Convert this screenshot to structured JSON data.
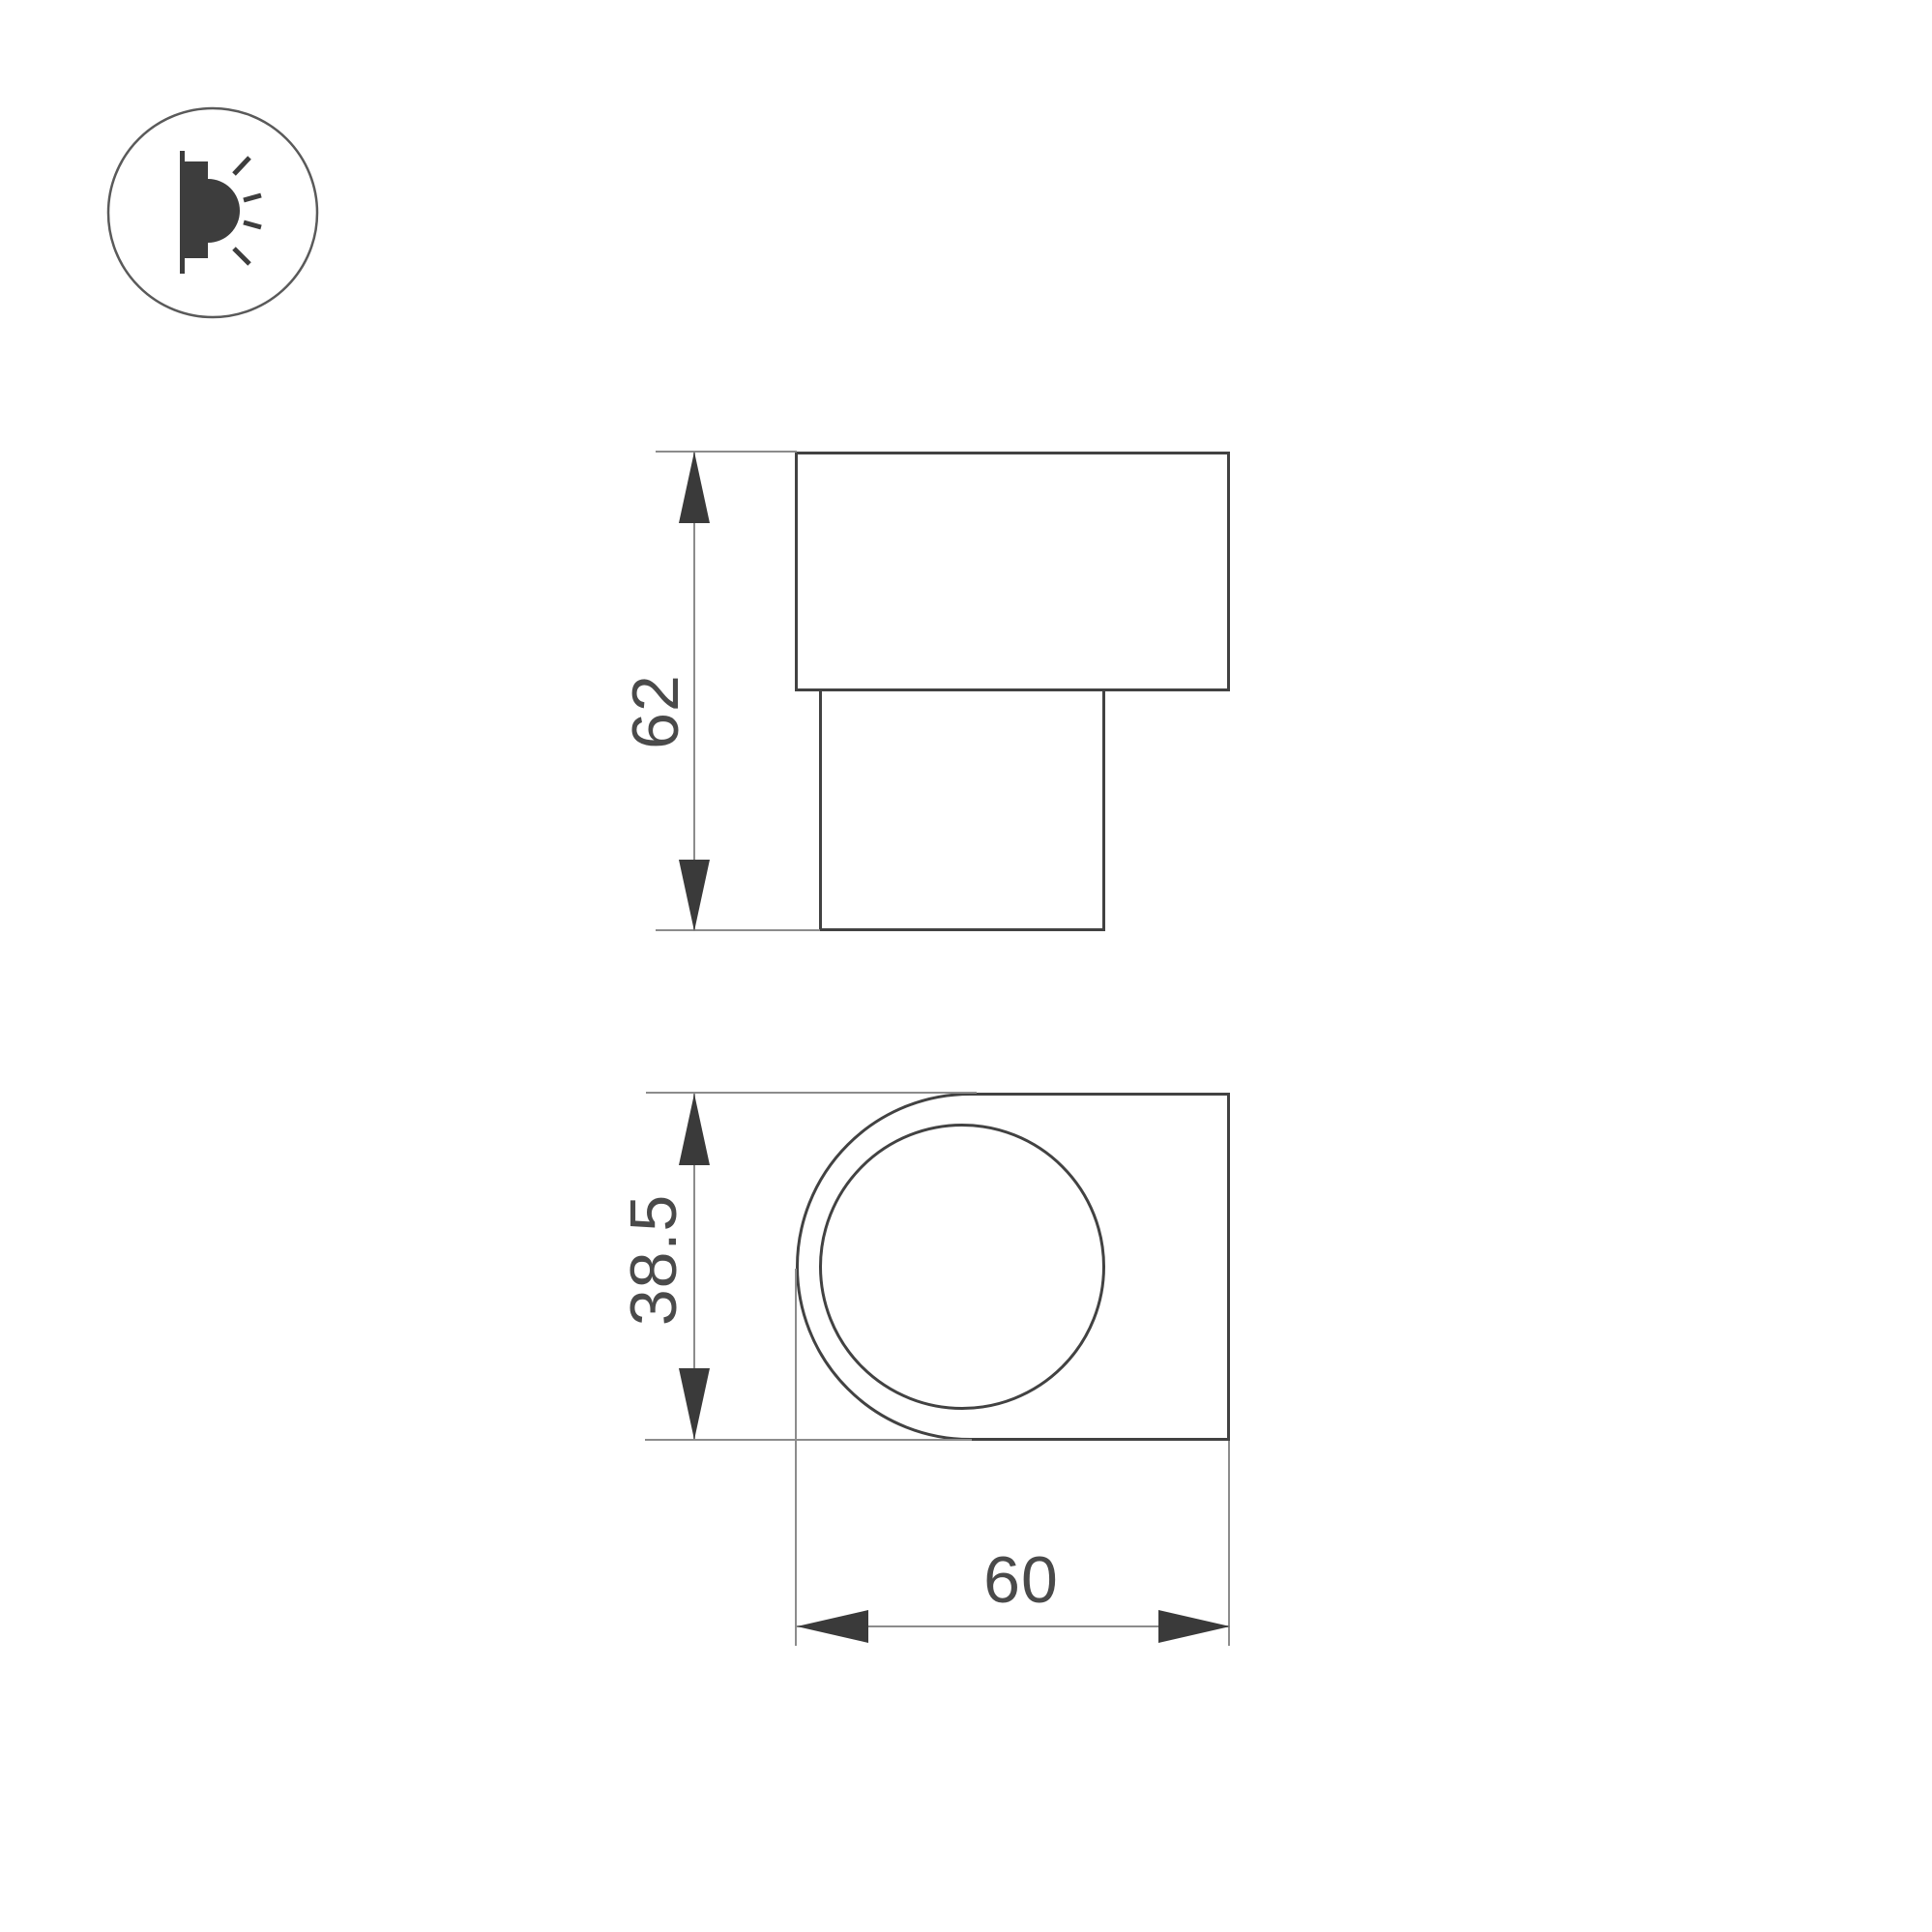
{
  "page": {
    "background": "#ffffff",
    "type_label": "product dimension drawing"
  },
  "colors": {
    "outline_strong": "#424242",
    "outline_thin": "#8c8c8c",
    "arrow_fill": "#3a3a3a",
    "text": "#4a4a4a",
    "icon_fill": "#3d3d3d"
  },
  "icon": {
    "name": "wall-lamp-emitting-light",
    "shape": "circle-outline-badge"
  },
  "dimensions_mm": {
    "height": 62,
    "depth": 38.5,
    "width": 60
  },
  "figures": {
    "side_view": {
      "height_label": "62"
    },
    "front_view": {
      "depth_label": "38.5",
      "width_label": "60"
    }
  }
}
